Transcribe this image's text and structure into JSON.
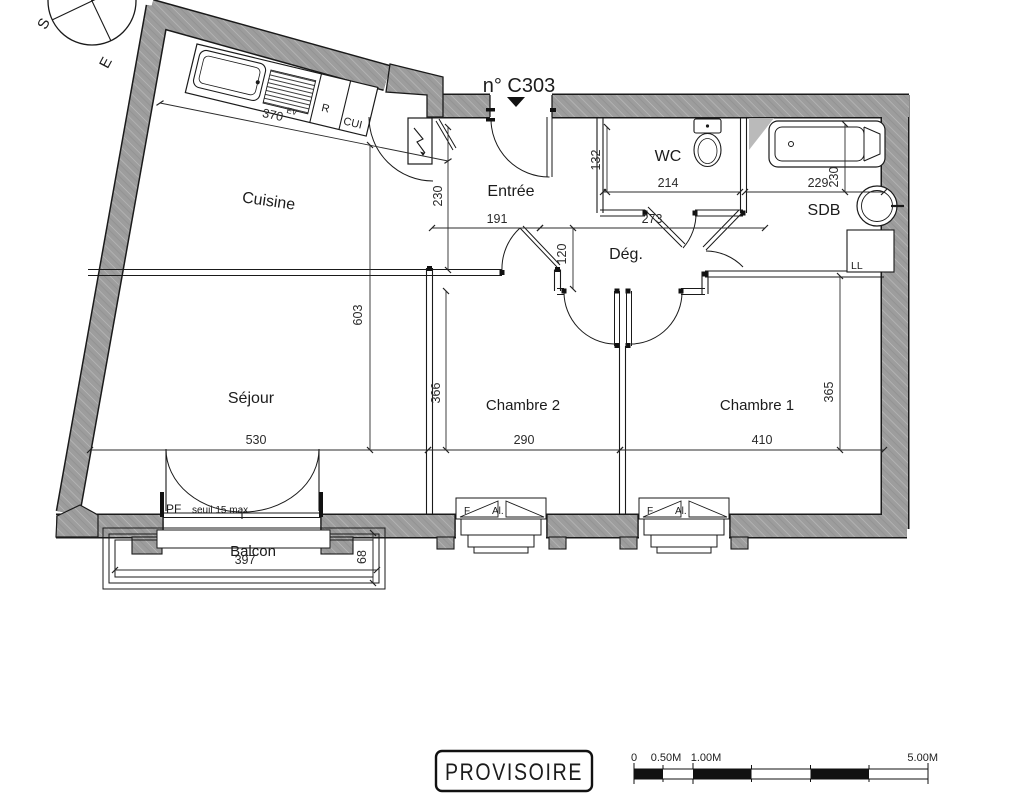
{
  "plan": {
    "unit_number": "n° C303",
    "rooms": {
      "cuisine": "Cuisine",
      "sejour": "Séjour",
      "entree": "Entrée",
      "wc": "WC",
      "sdb": "SDB",
      "degagement": "Dég.",
      "chambre2": "Chambre 2",
      "chambre1": "Chambre 1",
      "balcon": "Balcon"
    },
    "annotations": {
      "washing_machine": "LL",
      "door_window": "PF",
      "threshold": "seuil 15 max",
      "sink": "EV",
      "fridge": "R",
      "kitchen_unit": "CUI",
      "window_f": "F",
      "window_al": "Al."
    },
    "dimensions": {
      "cuisine_width": "370",
      "entree_depth": "230",
      "wc_height": "132",
      "wc_width": "214",
      "sdb_width": "229",
      "sdb_depth": "230",
      "entree_width": "191",
      "degagement_width": "273",
      "degagement_depth": "120",
      "left_zone_height": "603",
      "chambre2_depth": "366",
      "chambre2_width": "290",
      "chambre1_width": "410",
      "chambre1_depth": "365",
      "sejour_width": "530",
      "balcon_width": "397",
      "balcon_depth": "68"
    },
    "compass": {
      "south": "S",
      "east": "E"
    },
    "stamp": "PROVISOIRE",
    "scale_bar": {
      "t0": "0",
      "t05": "0.50M",
      "t1": "1.00M",
      "t5": "5.00M"
    }
  }
}
